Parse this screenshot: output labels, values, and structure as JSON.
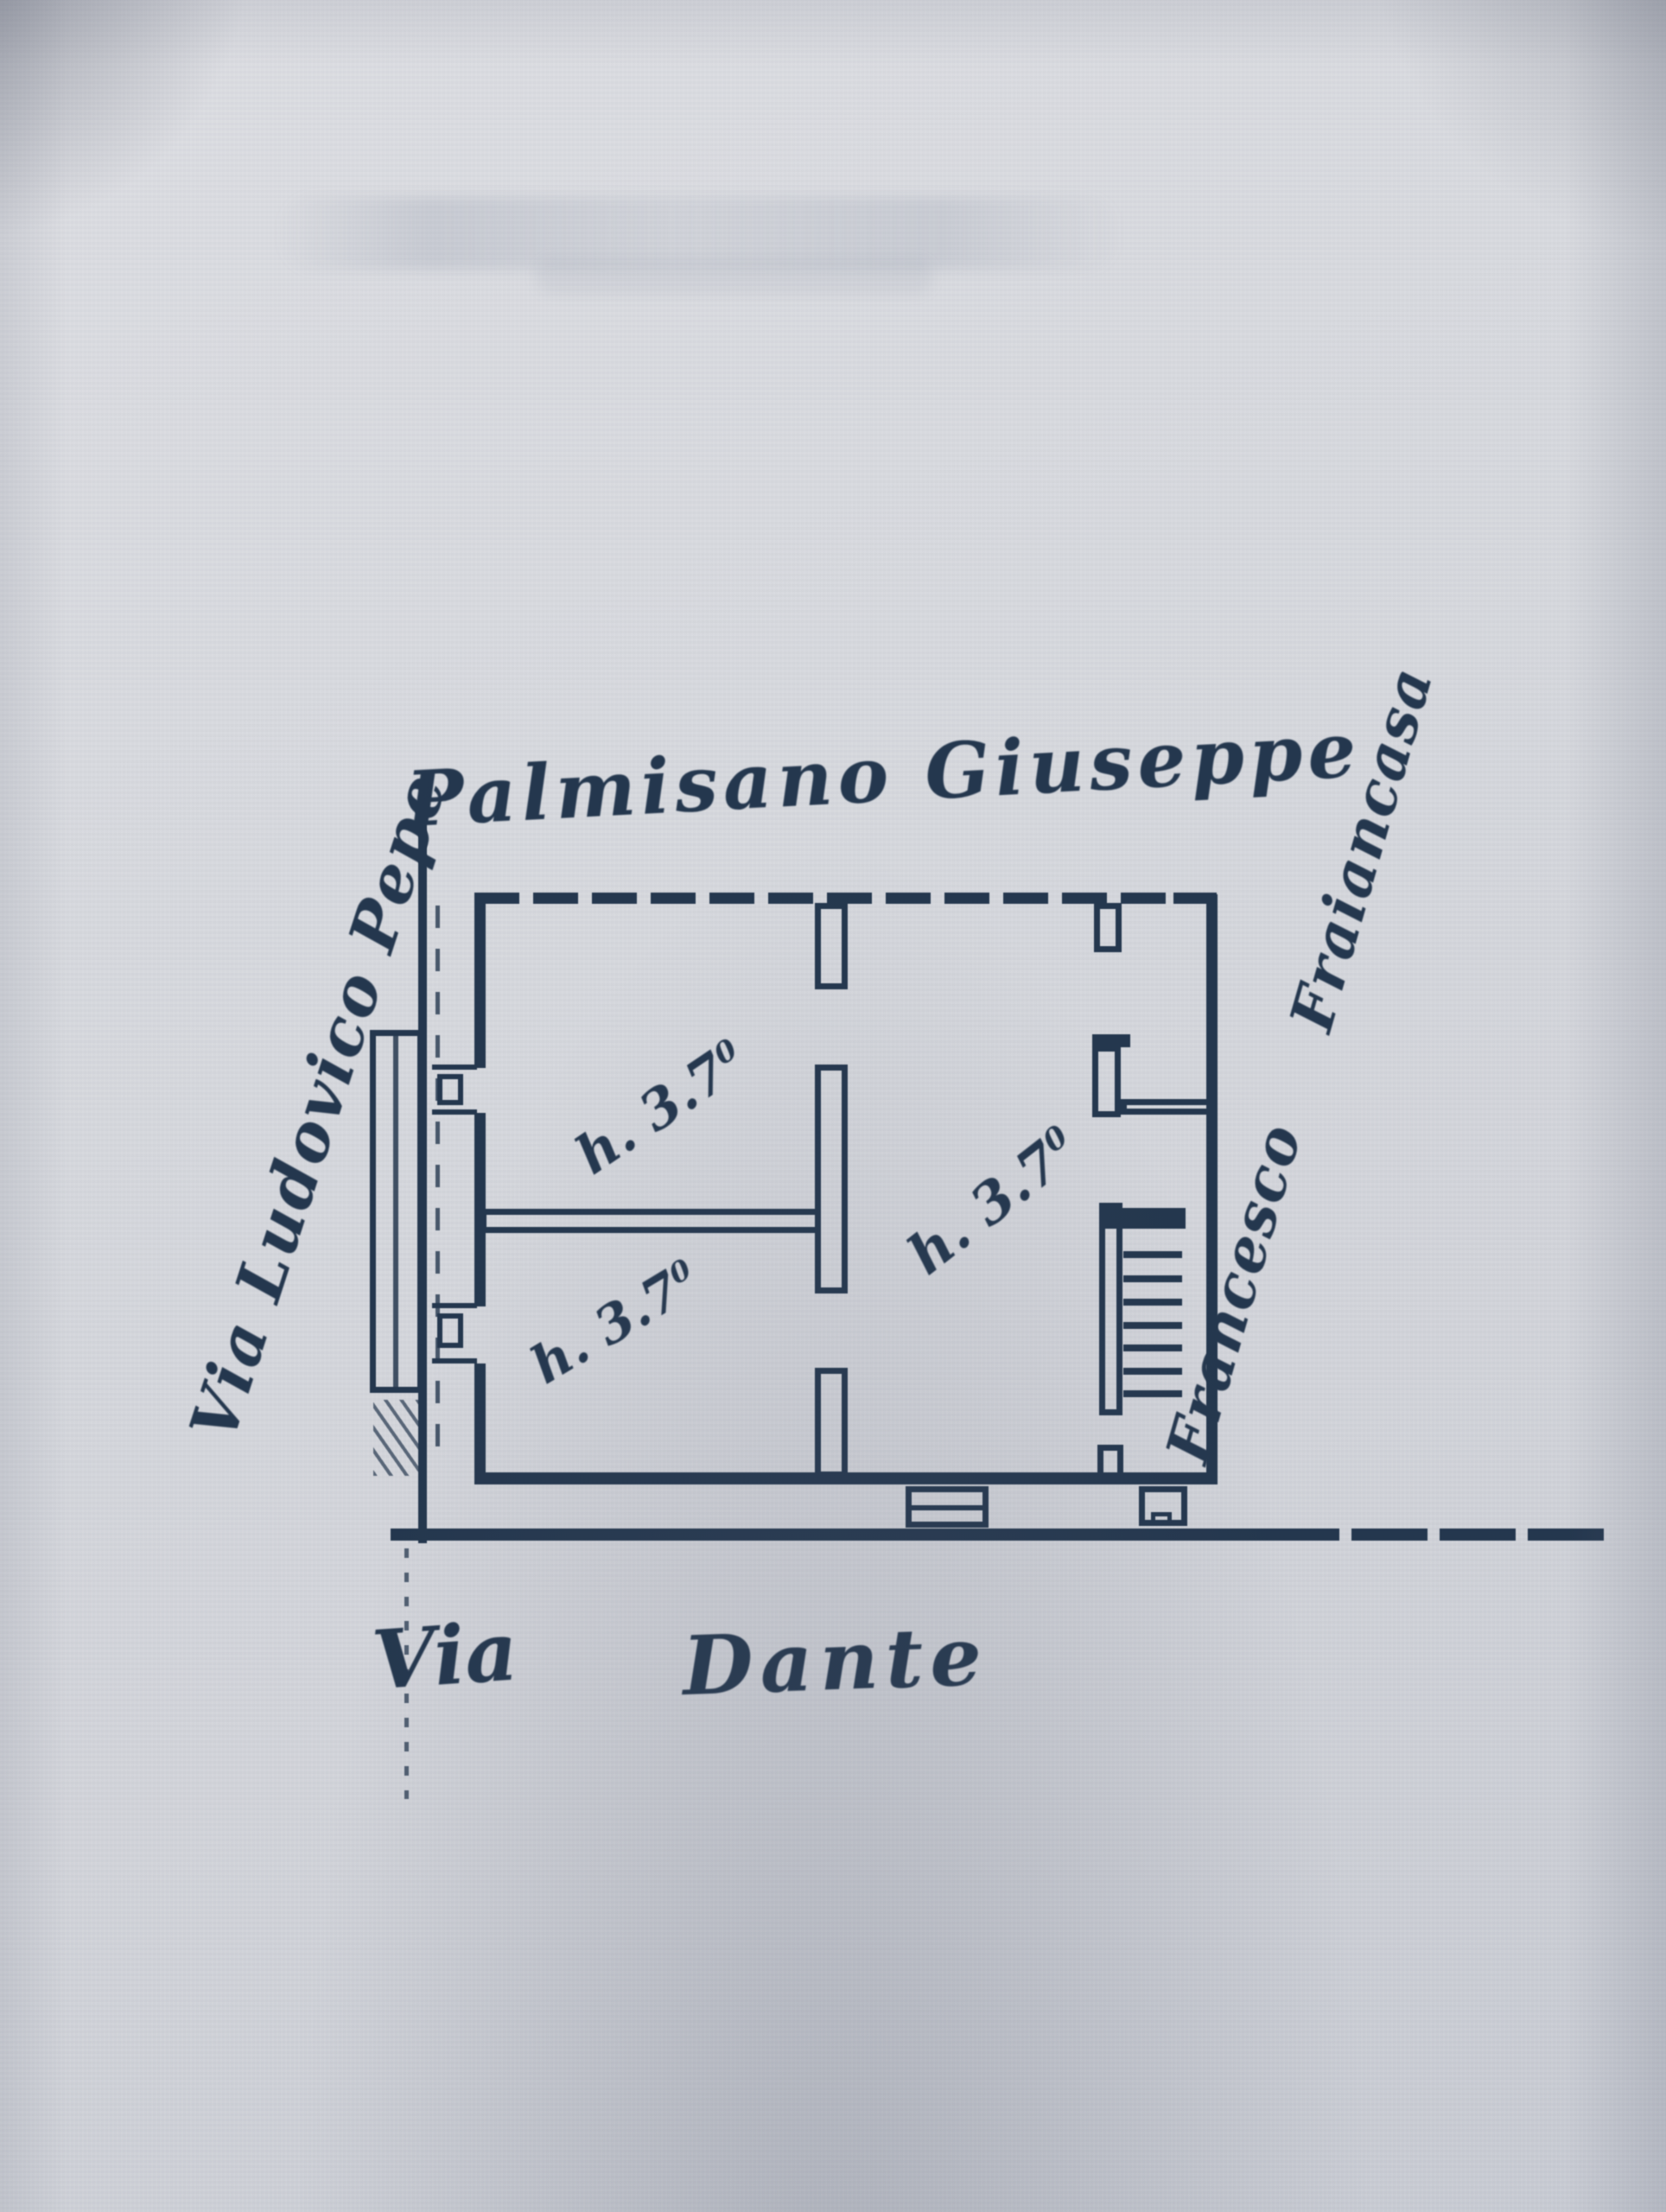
{
  "labels": {
    "owner_top": "Palmisano Giuseppe",
    "street_left": "Via Ludovico Pepe",
    "owner_right": "Francesco Fraiancasa",
    "street_bottom_via": "Via",
    "street_bottom_dante": "Dante"
  },
  "rooms": [
    {
      "name": "room-top-left",
      "height_label": "h. 3.7",
      "height_sup": "0"
    },
    {
      "name": "room-bottom-left",
      "height_label": "h. 3.7",
      "height_sup": "0"
    },
    {
      "name": "room-right",
      "height_label": "h. 3.7",
      "height_sup": "0"
    }
  ],
  "colors": {
    "paper": "#d7d8dd",
    "ink": "#24374e"
  }
}
